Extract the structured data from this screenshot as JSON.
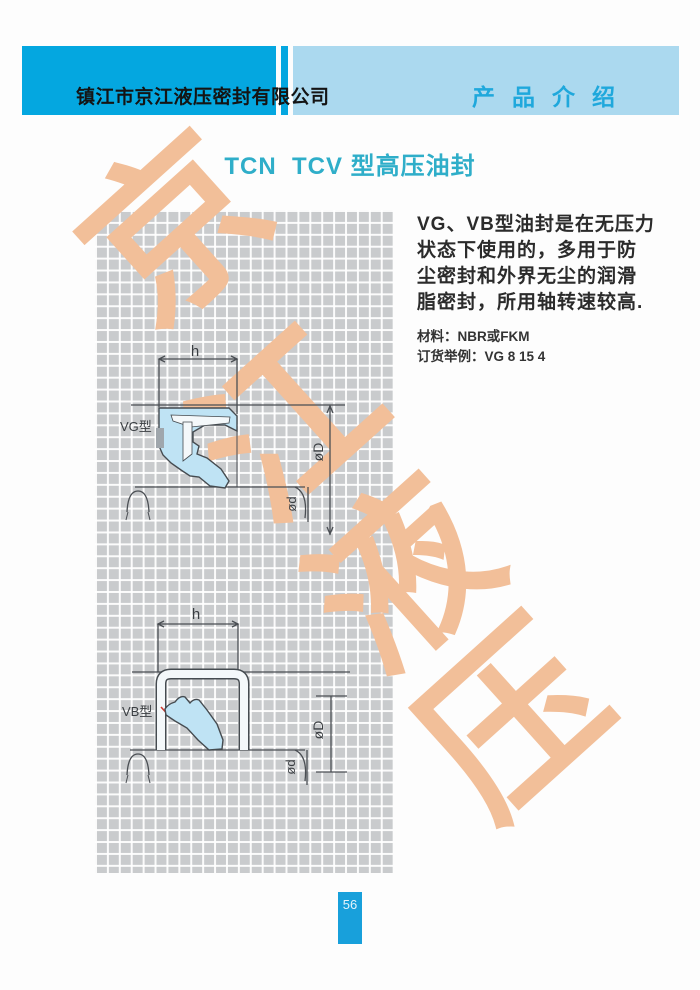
{
  "header": {
    "company_name": "镇江市京江液压密封有限公司",
    "section_label": "产品介绍"
  },
  "title": "TCN  TCV 型高压油封",
  "description": {
    "lines": [
      "VG、VB型油封是在无压力",
      "状态下使用的，多用于防",
      "尘密封和外界无尘的润滑",
      "脂密封，所用轴转速较高."
    ],
    "material": "材料：NBR或FKM",
    "order_example": "订货举例：VG 8 15 4"
  },
  "watermark": {
    "characters": [
      "京",
      "江",
      "液",
      "压"
    ],
    "color": "#f2bf99"
  },
  "diagrams": [
    {
      "label": "VG型",
      "dims": {
        "width": "h",
        "outer": "øD",
        "inner": "ød"
      }
    },
    {
      "label": "VB型",
      "dims": {
        "width": "h",
        "outer": "øD",
        "inner": "ød"
      }
    }
  ],
  "page": {
    "number": "56"
  },
  "colors": {
    "header_band": "#04a7e0",
    "header_band_light": "#abd9ef",
    "section_text": "#1fa8dc",
    "title_text": "#2faec9",
    "grid_bg": "#c9cbcd",
    "seal_fill": "#bfe3f4",
    "badge": "#18a0db"
  }
}
